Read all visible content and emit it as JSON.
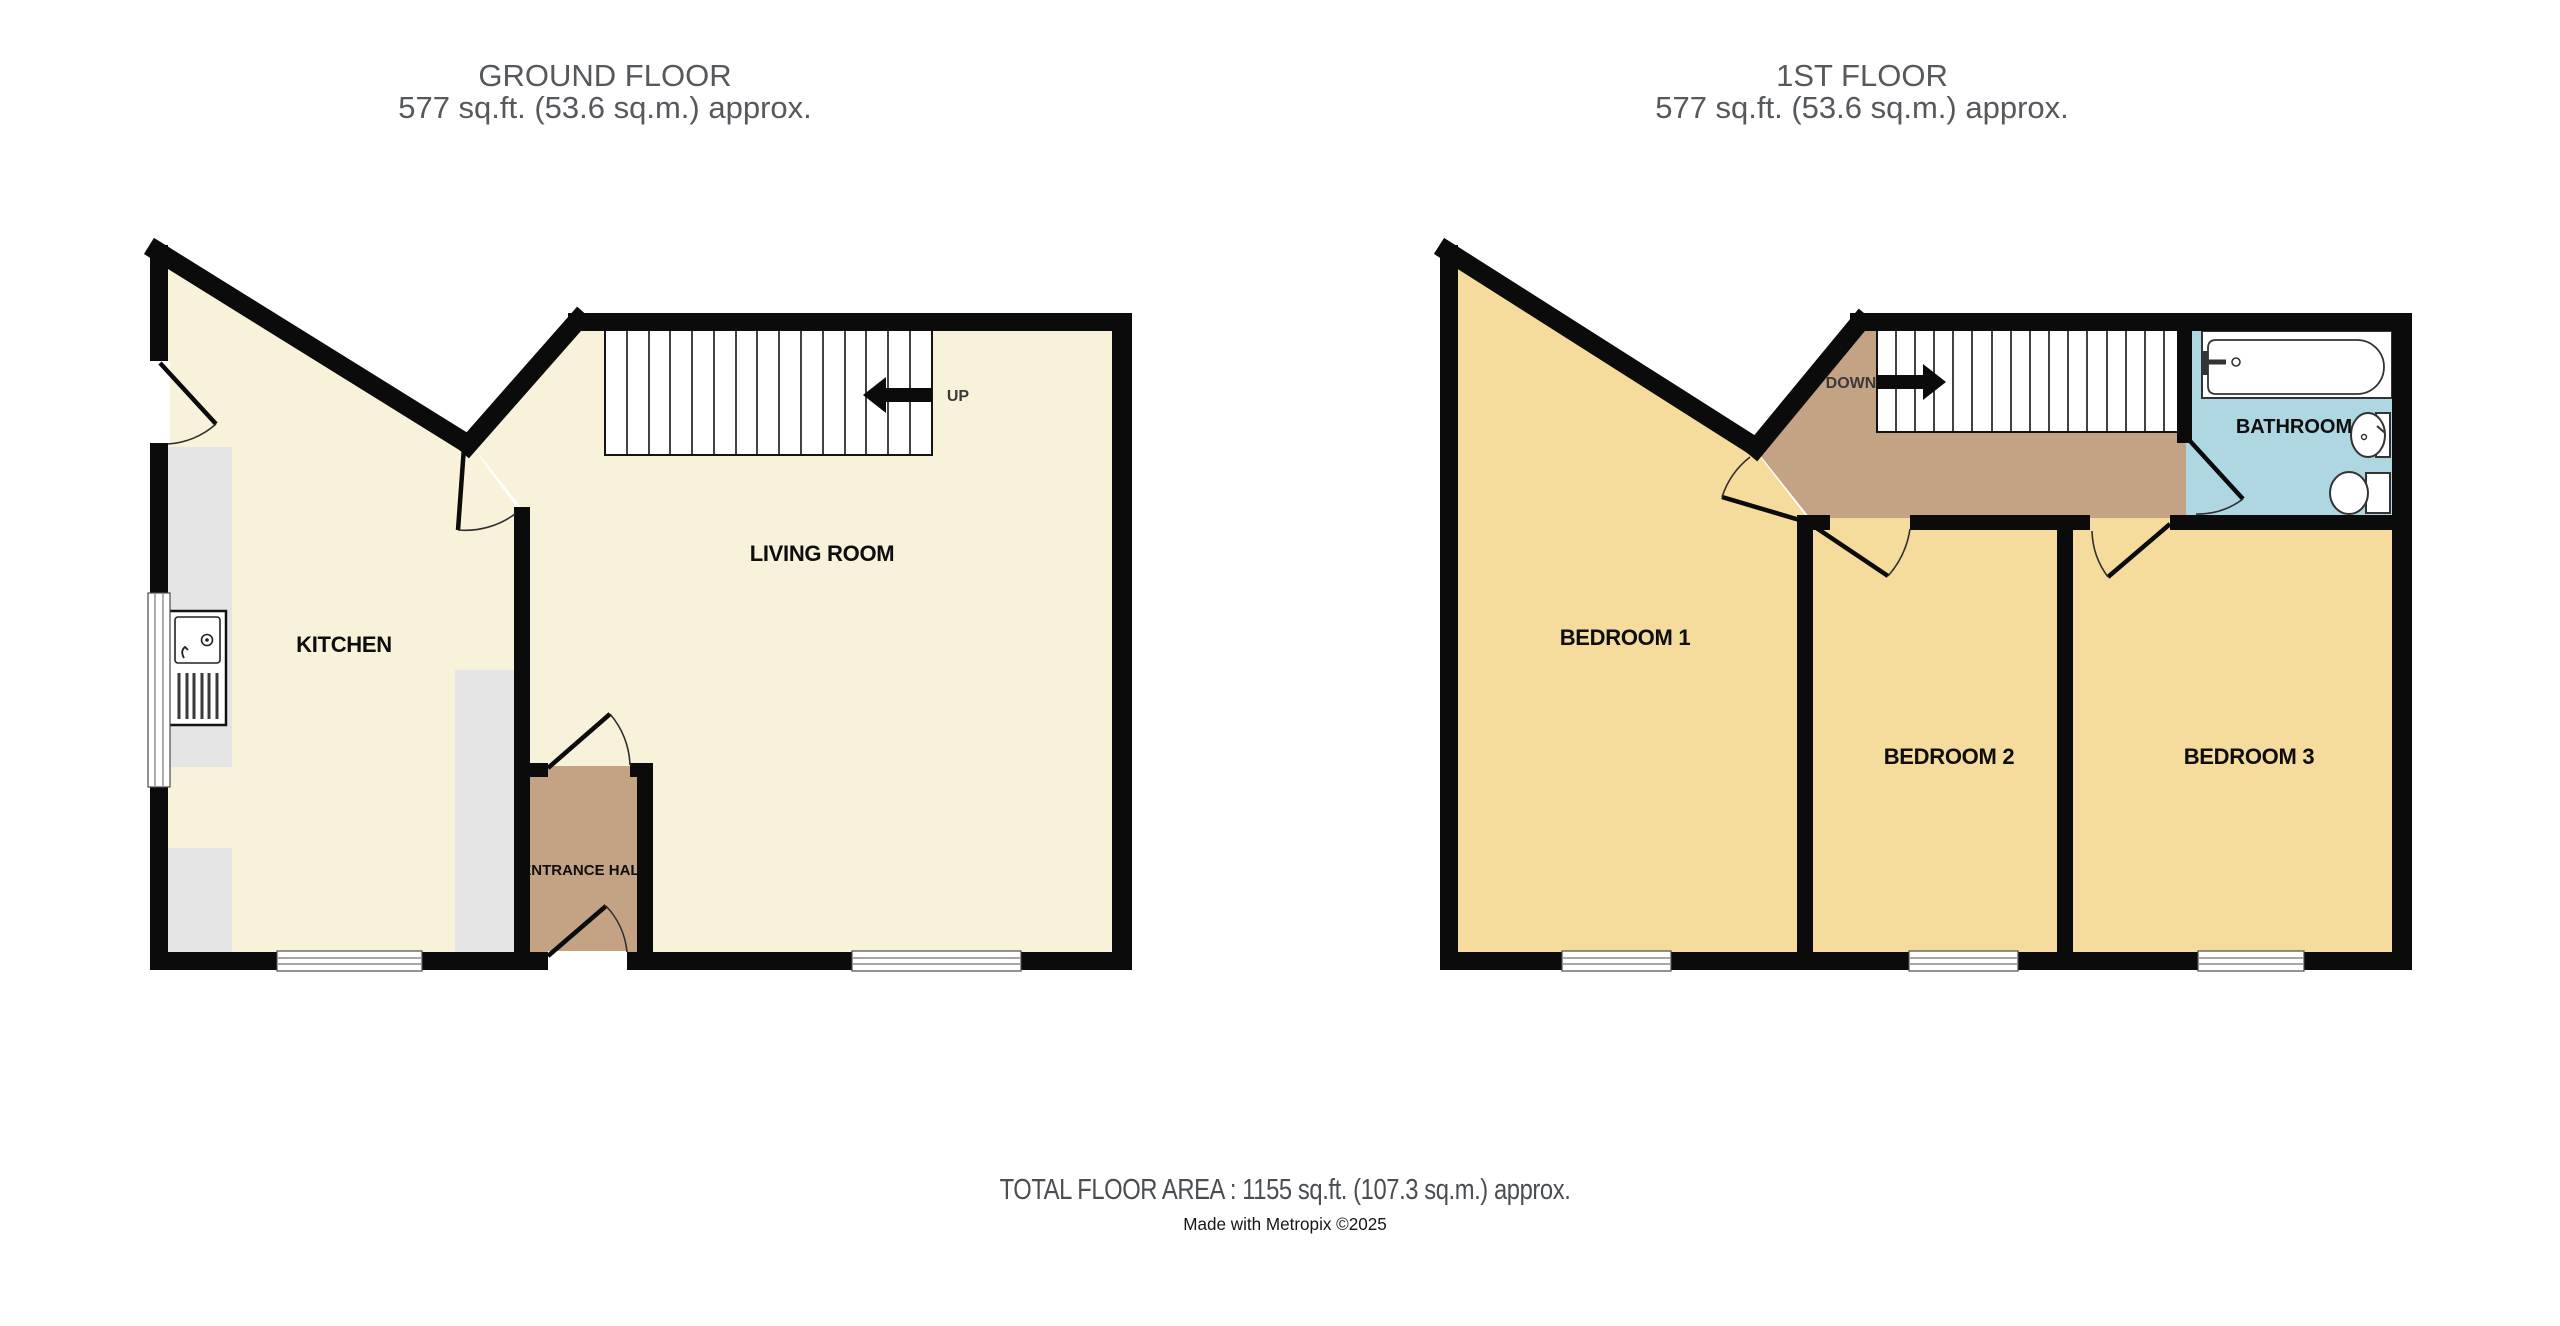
{
  "ground_floor": {
    "title": "GROUND FLOOR",
    "area": "577 sq.ft. (53.6 sq.m.) approx.",
    "rooms": {
      "kitchen": "KITCHEN",
      "living_room": "LIVING ROOM",
      "entrance_hall": "ENTRANCE HALL"
    },
    "stair_direction": "UP"
  },
  "first_floor": {
    "title": "1ST FLOOR",
    "area": "577 sq.ft. (53.6 sq.m.) approx.",
    "rooms": {
      "bedroom1": "BEDROOM 1",
      "bedroom2": "BEDROOM 2",
      "bedroom3": "BEDROOM 3",
      "bathroom": "BATHROOM"
    },
    "stair_direction": "DOWN"
  },
  "footer": {
    "total_area": "TOTAL FLOOR AREA : 1155 sq.ft. (107.3 sq.m.) approx.",
    "credit": "Made with Metropix ©2025"
  },
  "colors": {
    "wall": "#0b0b0b",
    "ground_room_fill": "#f8f2da",
    "bedroom_fill": "#f5dc9c",
    "hall_landing_fill": "#c4a384",
    "bathroom_fill": "#aed7e2",
    "counter_fill": "#e5e5e5",
    "title_text": "#55595d"
  }
}
